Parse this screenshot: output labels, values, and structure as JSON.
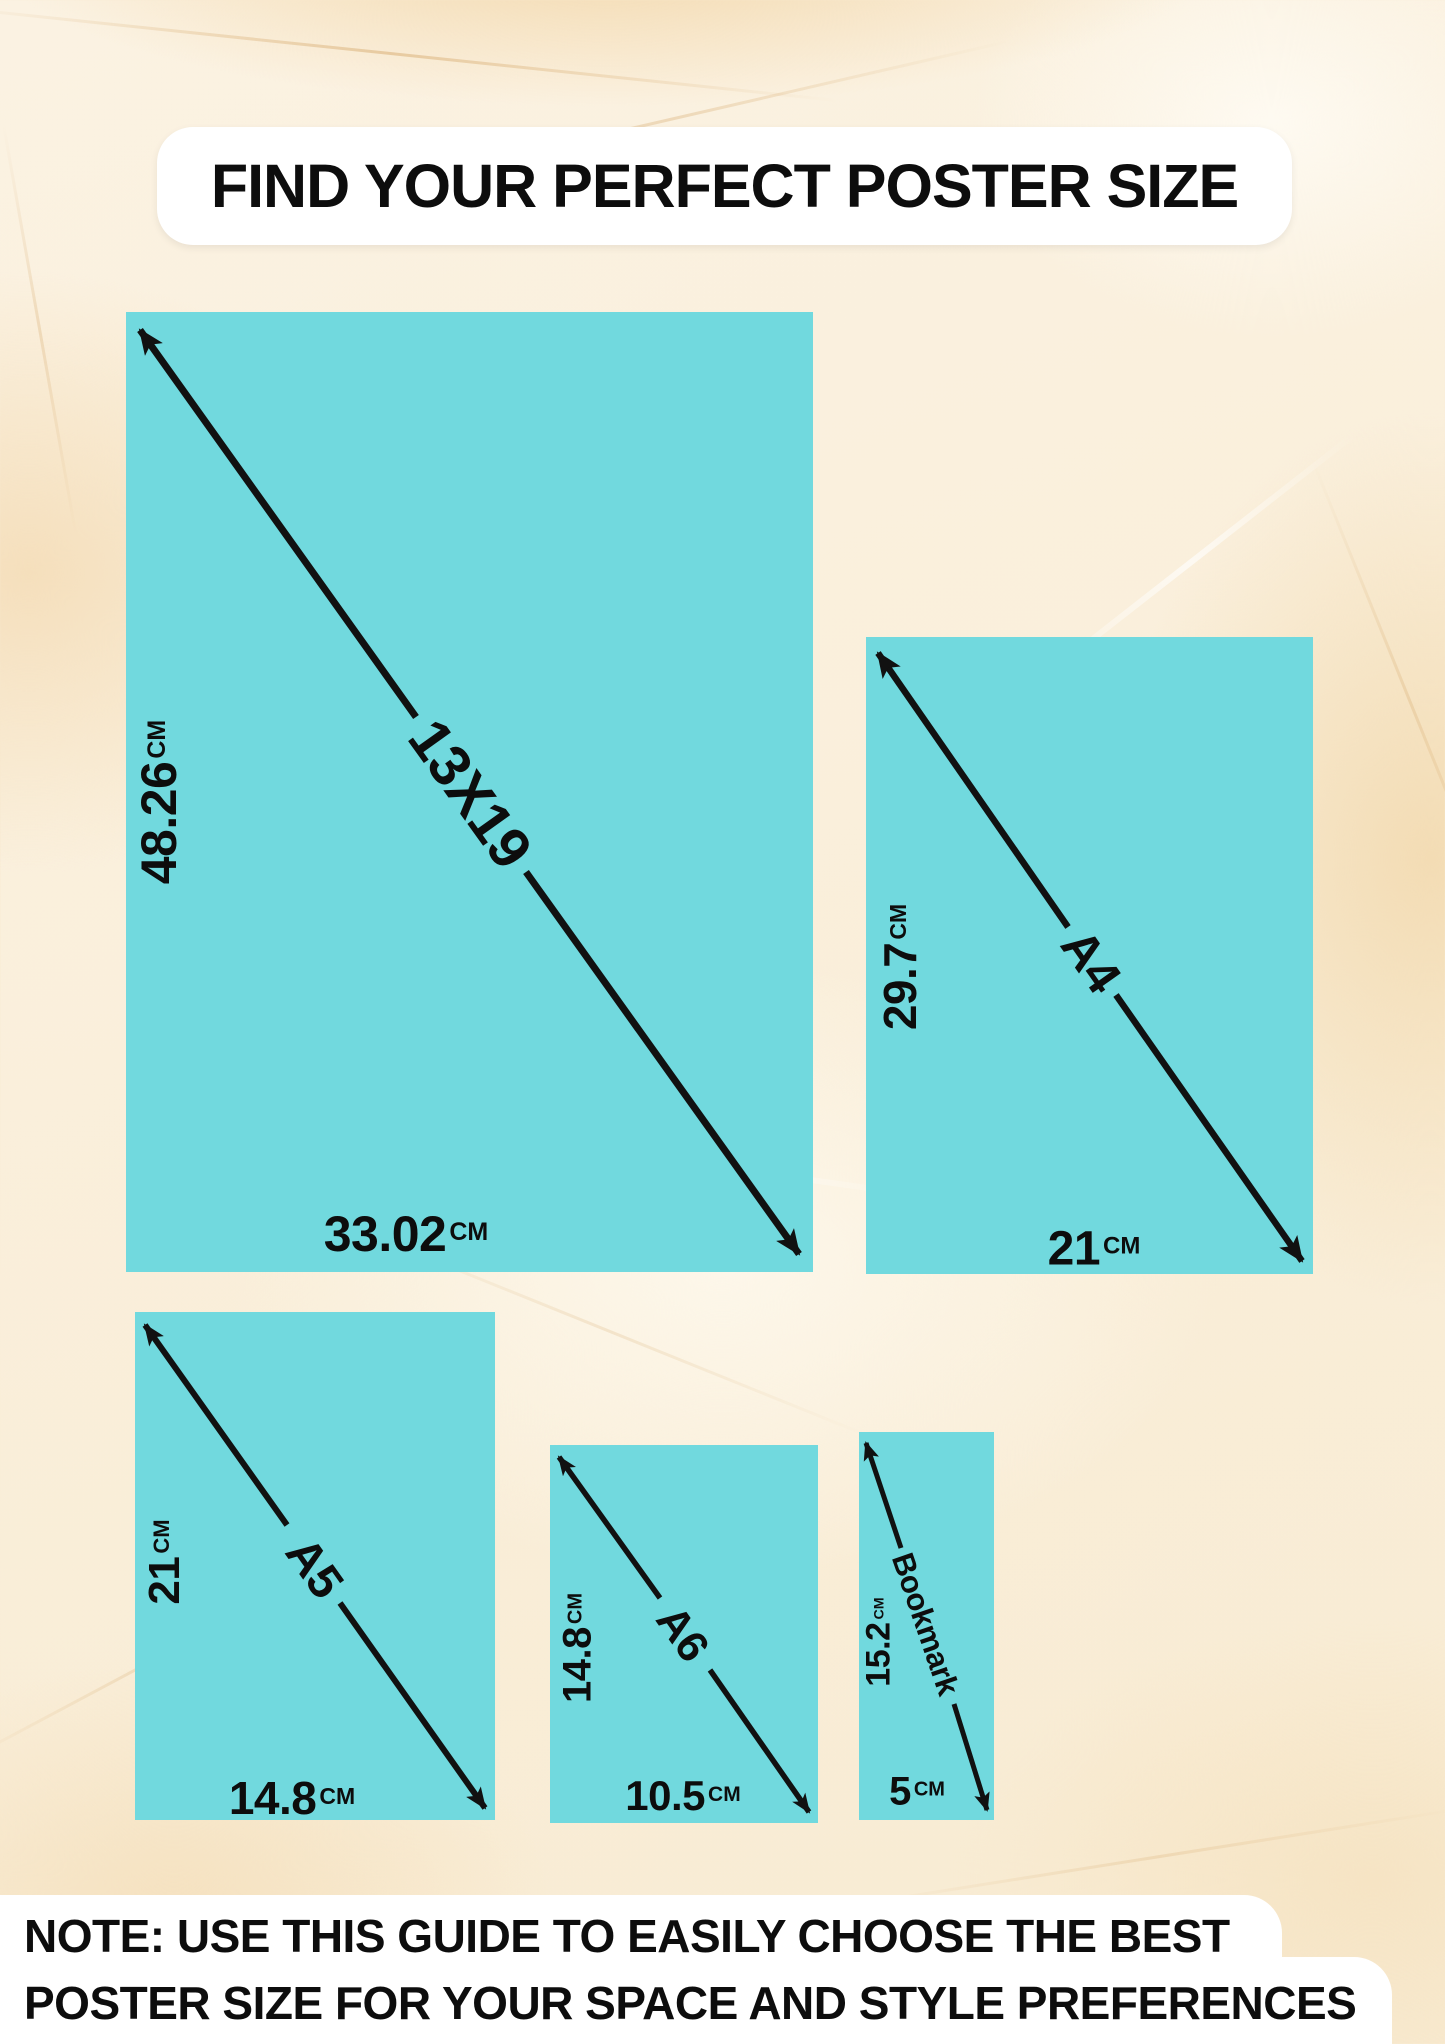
{
  "title": "FIND YOUR PERFECT POSTER SIZE",
  "note": {
    "line1": "NOTE: USE THIS GUIDE TO EASILY CHOOSE THE BEST",
    "line2": "POSTER SIZE FOR YOUR SPACE AND STYLE PREFERENCES"
  },
  "colors": {
    "poster_fill": "#71d9de",
    "arrow": "#111111",
    "background_base": "#f9eedb",
    "panel": "#ffffff",
    "text": "#0d0d0d"
  },
  "sizes": [
    {
      "id": "13x19",
      "name": "13X19",
      "height_value": "48.26",
      "height_unit": "CM",
      "width_value": "33.02",
      "width_unit": "CM"
    },
    {
      "id": "a4",
      "name": "A4",
      "height_value": "29.7",
      "height_unit": "CM",
      "width_value": "21",
      "width_unit": "CM"
    },
    {
      "id": "a5",
      "name": "A5",
      "height_value": "21",
      "height_unit": "CM",
      "width_value": "14.8",
      "width_unit": "CM"
    },
    {
      "id": "a6",
      "name": "A6",
      "height_value": "14.8",
      "height_unit": "CM",
      "width_value": "10.5",
      "width_unit": "CM"
    },
    {
      "id": "bookmark",
      "name": "Bookmark",
      "height_value": "15.2",
      "height_unit": "CM",
      "width_value": "5",
      "width_unit": "CM"
    }
  ]
}
